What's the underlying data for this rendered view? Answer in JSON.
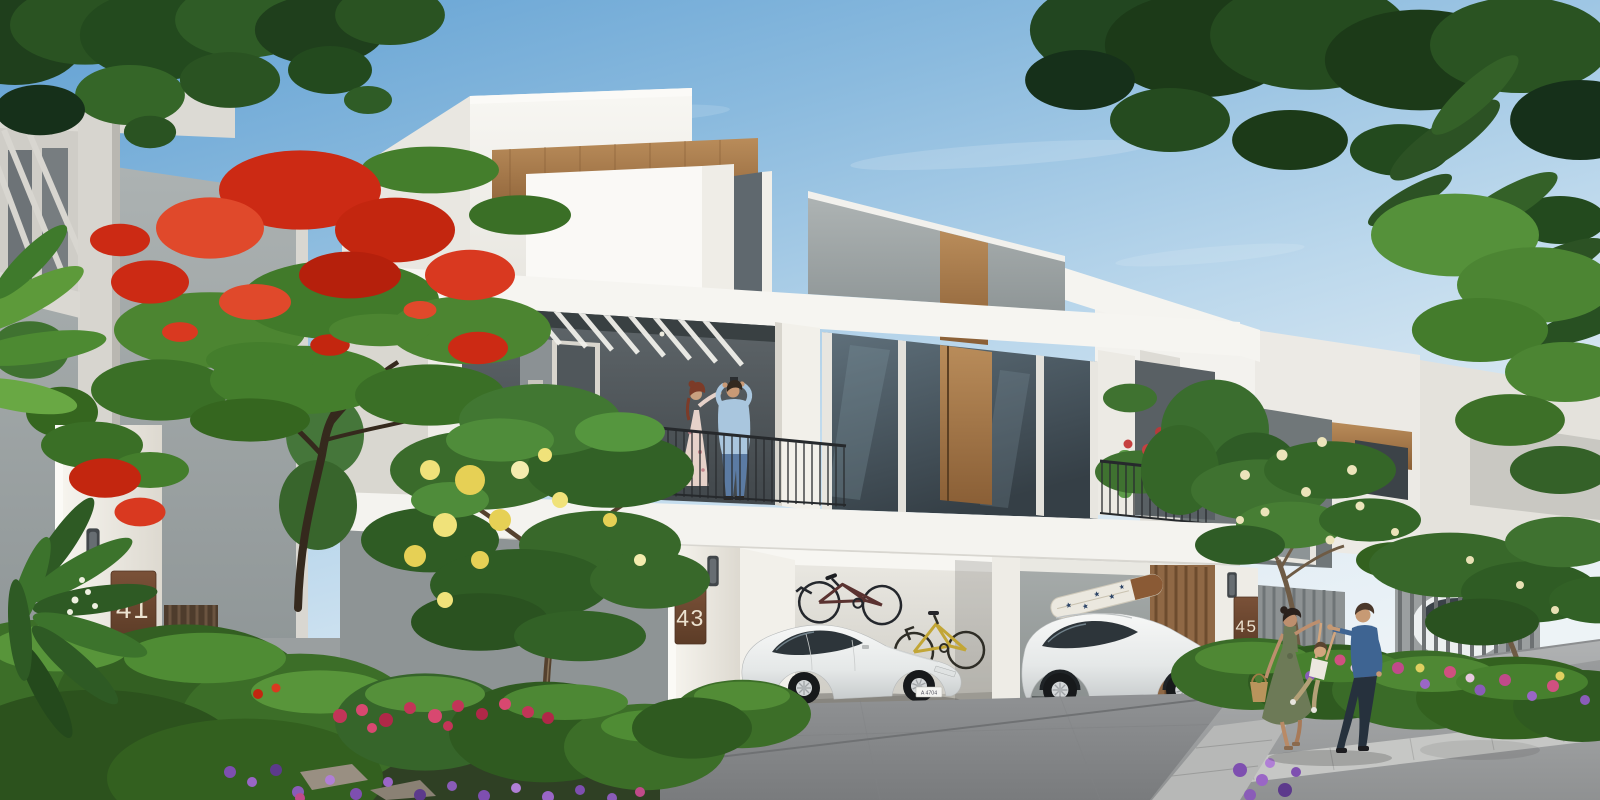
{
  "scene": {
    "setting": "modern villa community street view, daytime",
    "sky_color": "#5f9fd2",
    "wall_white": "#f4f2ec",
    "wall_grey": "#9aa0a1",
    "wood_accent": "#a87c4e",
    "hedge_green": "#3c6e28",
    "poinciana_red": "#cc2a14"
  },
  "houses": [
    {
      "name": "villa-41",
      "number": "41"
    },
    {
      "name": "villa-43",
      "number": "43"
    },
    {
      "name": "villa-45",
      "number": "45"
    }
  ],
  "vehicles": {
    "sedan": {
      "type": "electric sedan",
      "color": "white",
      "license_plate": "A 4704"
    },
    "suv": {
      "type": "SUV",
      "color": "white"
    },
    "bikes": [
      {
        "color": "dark",
        "placement": "wall-mounted in carport"
      },
      {
        "color": "yellow",
        "placement": "standing in carport"
      }
    ]
  },
  "people": {
    "balcony": [
      "woman in floral dress",
      "man in light blue shirt"
    ],
    "street": [
      "mother in olive dress with basket",
      "child swinging between parents",
      "father in blue shirt"
    ]
  },
  "props": {
    "surfboard": "white with navy stars and wooden nose"
  }
}
